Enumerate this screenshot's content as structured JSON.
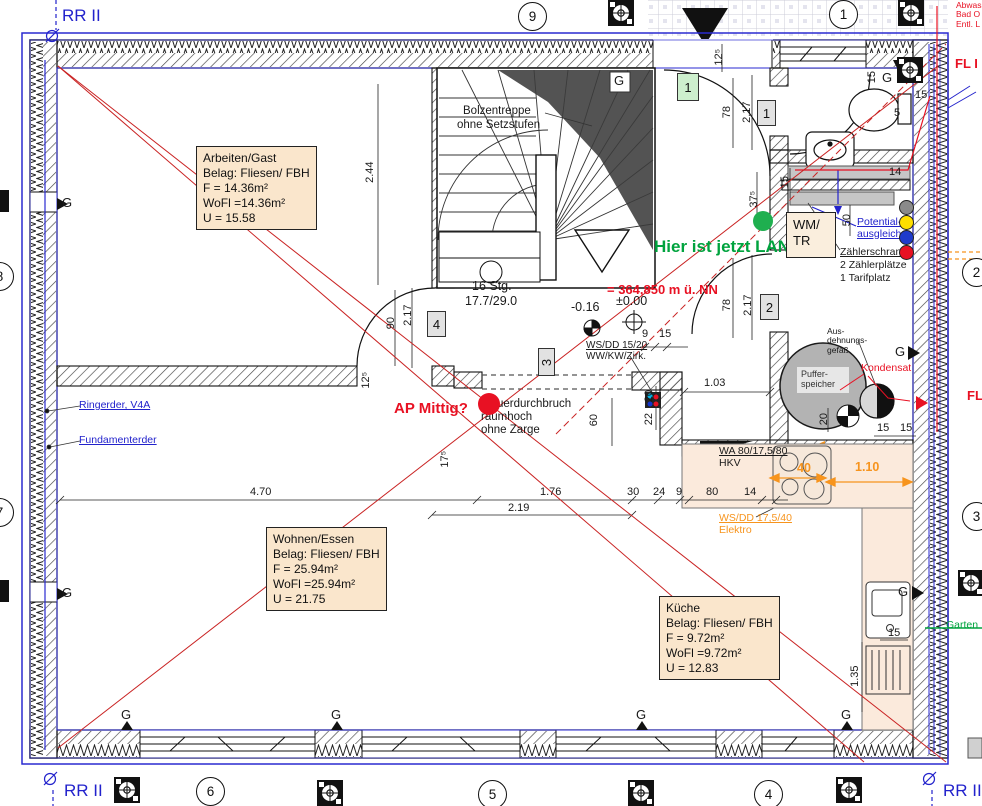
{
  "labels": {
    "rr": "RR II",
    "g": "G",
    "lan": "Hier ist jetzt LAN",
    "ap": "AP Mittig?",
    "level_nn": "= 364,850 m ü. NN",
    "level_zero": "±0.00",
    "level_minus": "-0.16",
    "mdb1": "Mauerdurchbruch",
    "mdb2": "raumhoch",
    "mdb3": "ohne Zarge",
    "stair1": "Bolzentreppe",
    "stair2": "ohne Setzstufen",
    "stair3": "16 Stg.",
    "stair4": "17.7/29.0",
    "wm1": "WM/",
    "wm2": "TR",
    "pot1": "Potential-",
    "pot2": "ausgleich",
    "zs1": "Zählerschrank",
    "zs2": "2 Zählerplätze",
    "zs3": "1 Tarifplatz",
    "puffer1": "Puffer-",
    "puffer2": "speicher",
    "adg1": "Aus-",
    "adg2": "dehnungs-",
    "adg3": "gefäß",
    "kondensat": "Kondensat",
    "wa1": "WA 80/17,5/80",
    "wa2": "HKV",
    "wsdd_e1": "WS/DD 17,5/40",
    "wsdd_e2": "Elektro",
    "wsdd_w1": "WS/DD 15/20",
    "wsdd_w2": "WW/KW/Zirk.",
    "ring": "Ringerder, V4A",
    "fund": "Fundamenterder",
    "abw1": "Abwass",
    "abw2": "Bad O",
    "abw3": "Entl. L",
    "fl1": "FL I",
    "fl2": "FL",
    "garten": "Garten"
  },
  "grid": {
    "n9": "9",
    "n1": "1",
    "n8": "8",
    "n7": "7",
    "n2": "2",
    "n3": "3",
    "n6": "6",
    "n5": "5",
    "n4": "4"
  },
  "chips": {
    "green1": "1",
    "gray1": "1",
    "c2": "2",
    "c3": "3",
    "c4": "4"
  },
  "rooms": {
    "arbeiten": [
      "Arbeiten/Gast",
      "Belag: Fliesen/ FBH",
      "F = 14.36m²",
      "WoFl =14.36m²",
      "U = 15.58"
    ],
    "wohnen": [
      "Wohnen/Essen",
      "Belag: Fliesen/ FBH",
      "F = 25.94m²",
      "WoFl =25.94m²",
      "U = 21.75"
    ],
    "kueche": [
      "Küche",
      "Belag: Fliesen/ FBH",
      "F = 9.72m²",
      "WoFl =9.72m²",
      "U = 12.83"
    ]
  },
  "dims": {
    "d244": "2.44",
    "d217": "2.17",
    "d90": "90",
    "d78": "78",
    "d125": "12⁵",
    "d375": "37⁵",
    "d175": "17⁵",
    "d470": "4.70",
    "d176": "1.76",
    "d219": "2.19",
    "d30": "30",
    "d24": "24",
    "d9": "9",
    "d80": "80",
    "d14": "14",
    "d15": "15",
    "d5": "5",
    "d50": "50",
    "d103": "1.03",
    "d60": "60",
    "d22": "22",
    "d20": "20",
    "d40": "40",
    "d110": "1.10",
    "d135": "1.35"
  },
  "colors": {
    "red": "#e81123",
    "green": "#00a33e",
    "blue": "#2222cc",
    "orange": "#f7941d",
    "beige": "#fae6cc"
  }
}
